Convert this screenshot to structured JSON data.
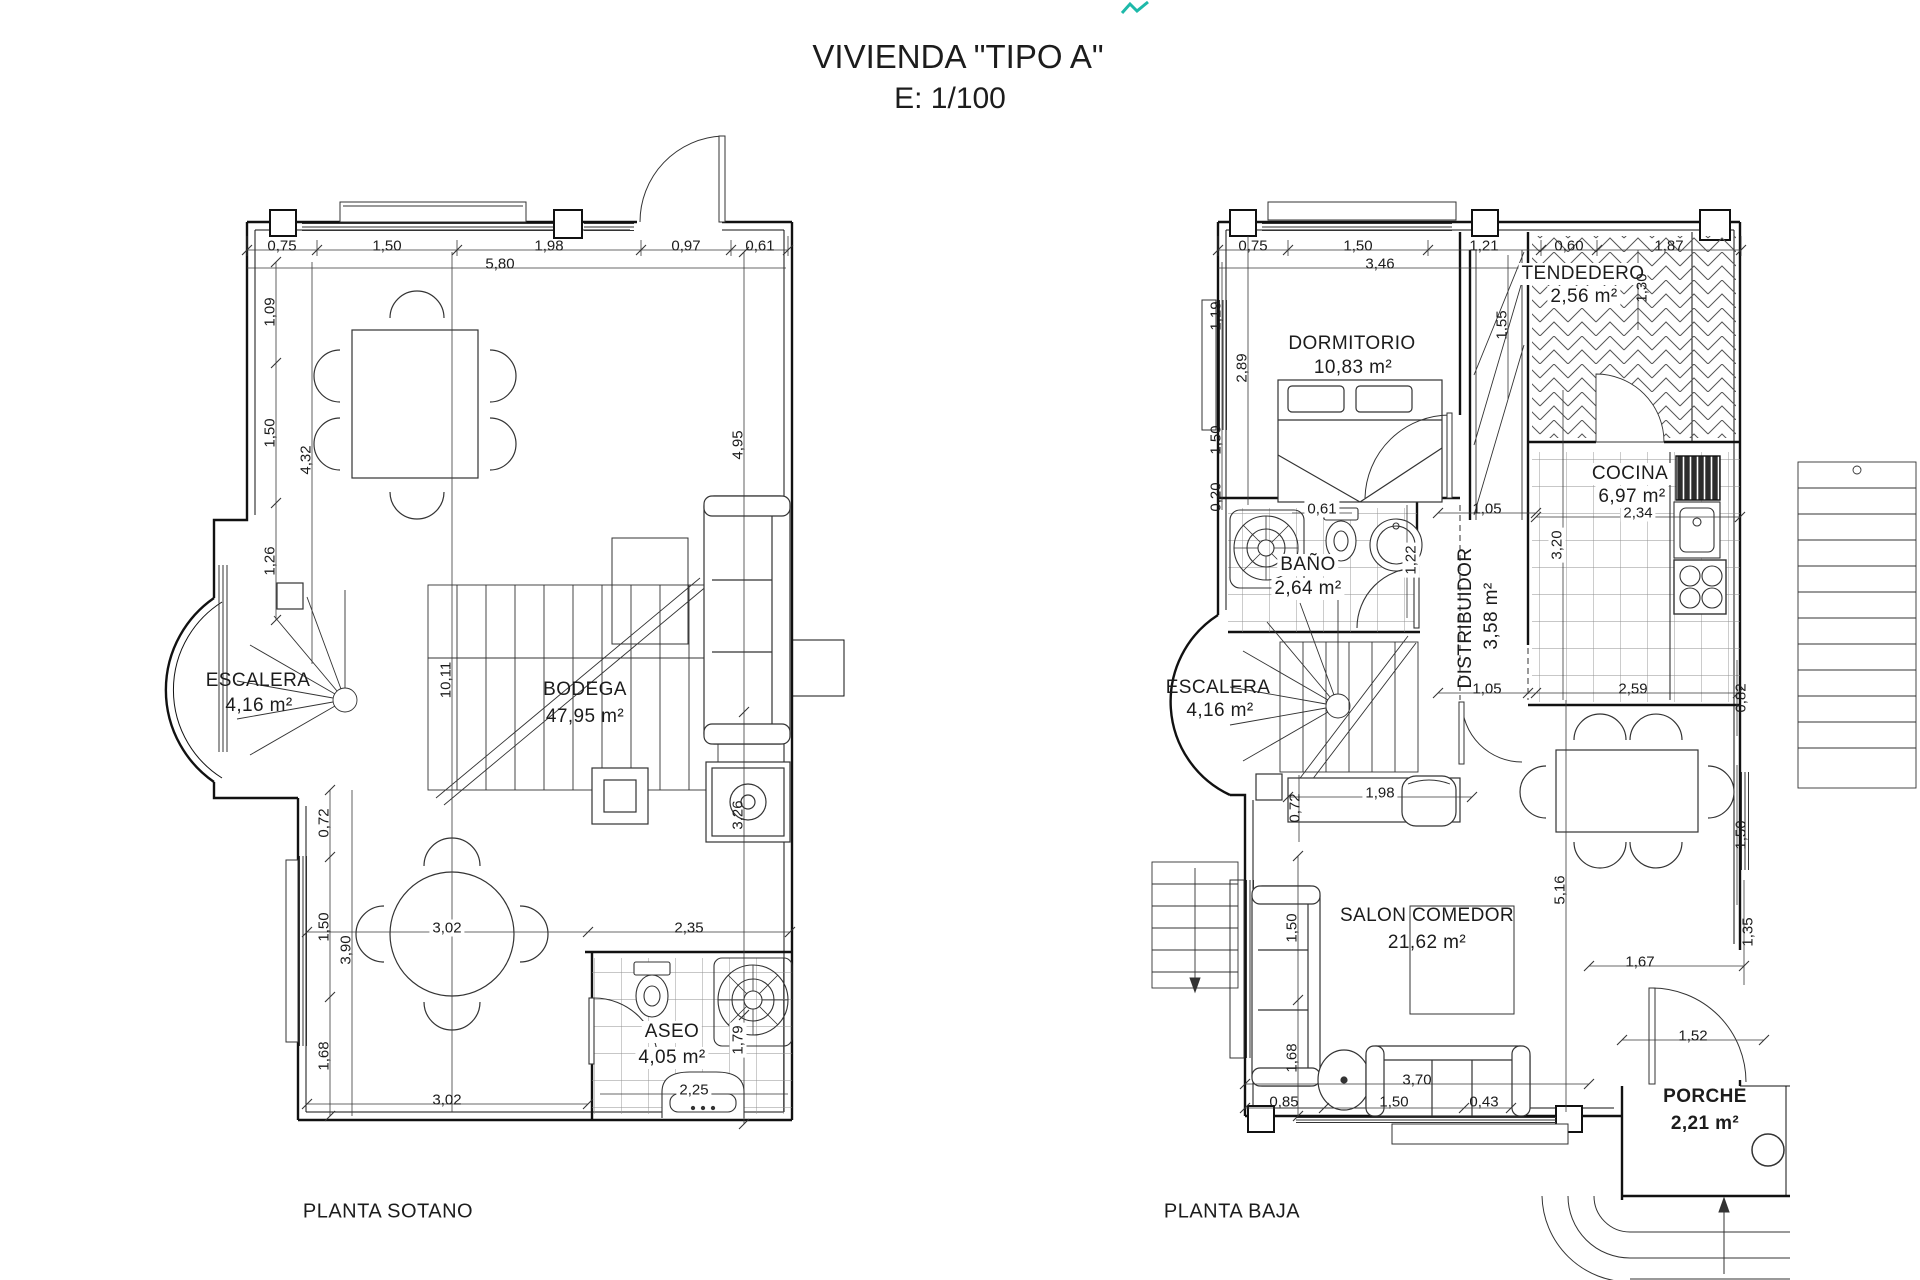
{
  "title": {
    "line1": "VIVIENDA \"TIPO A\"",
    "line2": "E: 1/100"
  },
  "accent_mark_color": "#1db9a9",
  "sotano": {
    "floor_label": "PLANTA SOTANO",
    "rooms": {
      "escalera": {
        "name": "ESCALERA",
        "area": "4,16 m²"
      },
      "bodega": {
        "name": "BODEGA",
        "area": "47,95 m²"
      },
      "aseo": {
        "name": "ASEO",
        "area": "4,05 m²"
      }
    },
    "dims": {
      "top": [
        "0,75",
        "1,50",
        "1,98",
        "0,97",
        "0,61"
      ],
      "top_total": "5,80",
      "left": [
        "1,09",
        "1,50",
        "1,26"
      ],
      "left_total": "4,32",
      "height_total": "10,11",
      "lower_left": [
        "0,72",
        "1,50",
        "1,68"
      ],
      "lower_left_total": "3,90",
      "mid": [
        "3,02",
        "2,35"
      ],
      "bottom": "3,02",
      "aseo_sink": "2,25",
      "right": [
        "4,95",
        "3,26",
        "1,79"
      ]
    }
  },
  "baja": {
    "floor_label": "PLANTA BAJA",
    "rooms": {
      "dormitorio": {
        "name": "DORMITORIO",
        "area": "10,83 m²"
      },
      "tendedero": {
        "name": "TENDEDERO",
        "area": "2,56 m²"
      },
      "cocina": {
        "name": "COCINA",
        "area": "6,97 m²"
      },
      "bano": {
        "name": "BAÑO",
        "area": "2,64 m²"
      },
      "distribuidor": {
        "name": "DISTRIBUIDOR",
        "area": "3,58 m²"
      },
      "escalera": {
        "name": "ESCALERA",
        "area": "4,16 m²"
      },
      "salon": {
        "name": "SALON COMEDOR",
        "area": "21,62 m²"
      },
      "porche": {
        "name": "PORCHE",
        "area": "2,21 m²"
      }
    },
    "dims": {
      "top": [
        "0,75",
        "1,50",
        "1,21",
        "0,60",
        "1,87"
      ],
      "top_total": "3,46",
      "left": [
        "1,19",
        "2,89",
        "1,50",
        "0,20"
      ],
      "wardrobe": "1,55",
      "tendedero": "1,30",
      "bano": [
        "0,61",
        "1,22"
      ],
      "hall": [
        "1,05",
        "1,05"
      ],
      "cocina": [
        "2,34",
        "3,20"
      ],
      "stair": [
        "1,98",
        "0,72"
      ],
      "salon": [
        "2,59",
        "0,82",
        "1,50",
        "5,16",
        "1,35"
      ],
      "salon_left": [
        "1,50",
        "1,68"
      ],
      "porch": [
        "1,67",
        "1,52"
      ],
      "bottom": [
        "0,85",
        "1,50",
        "0,43"
      ],
      "bottom_total": "3,70"
    }
  }
}
